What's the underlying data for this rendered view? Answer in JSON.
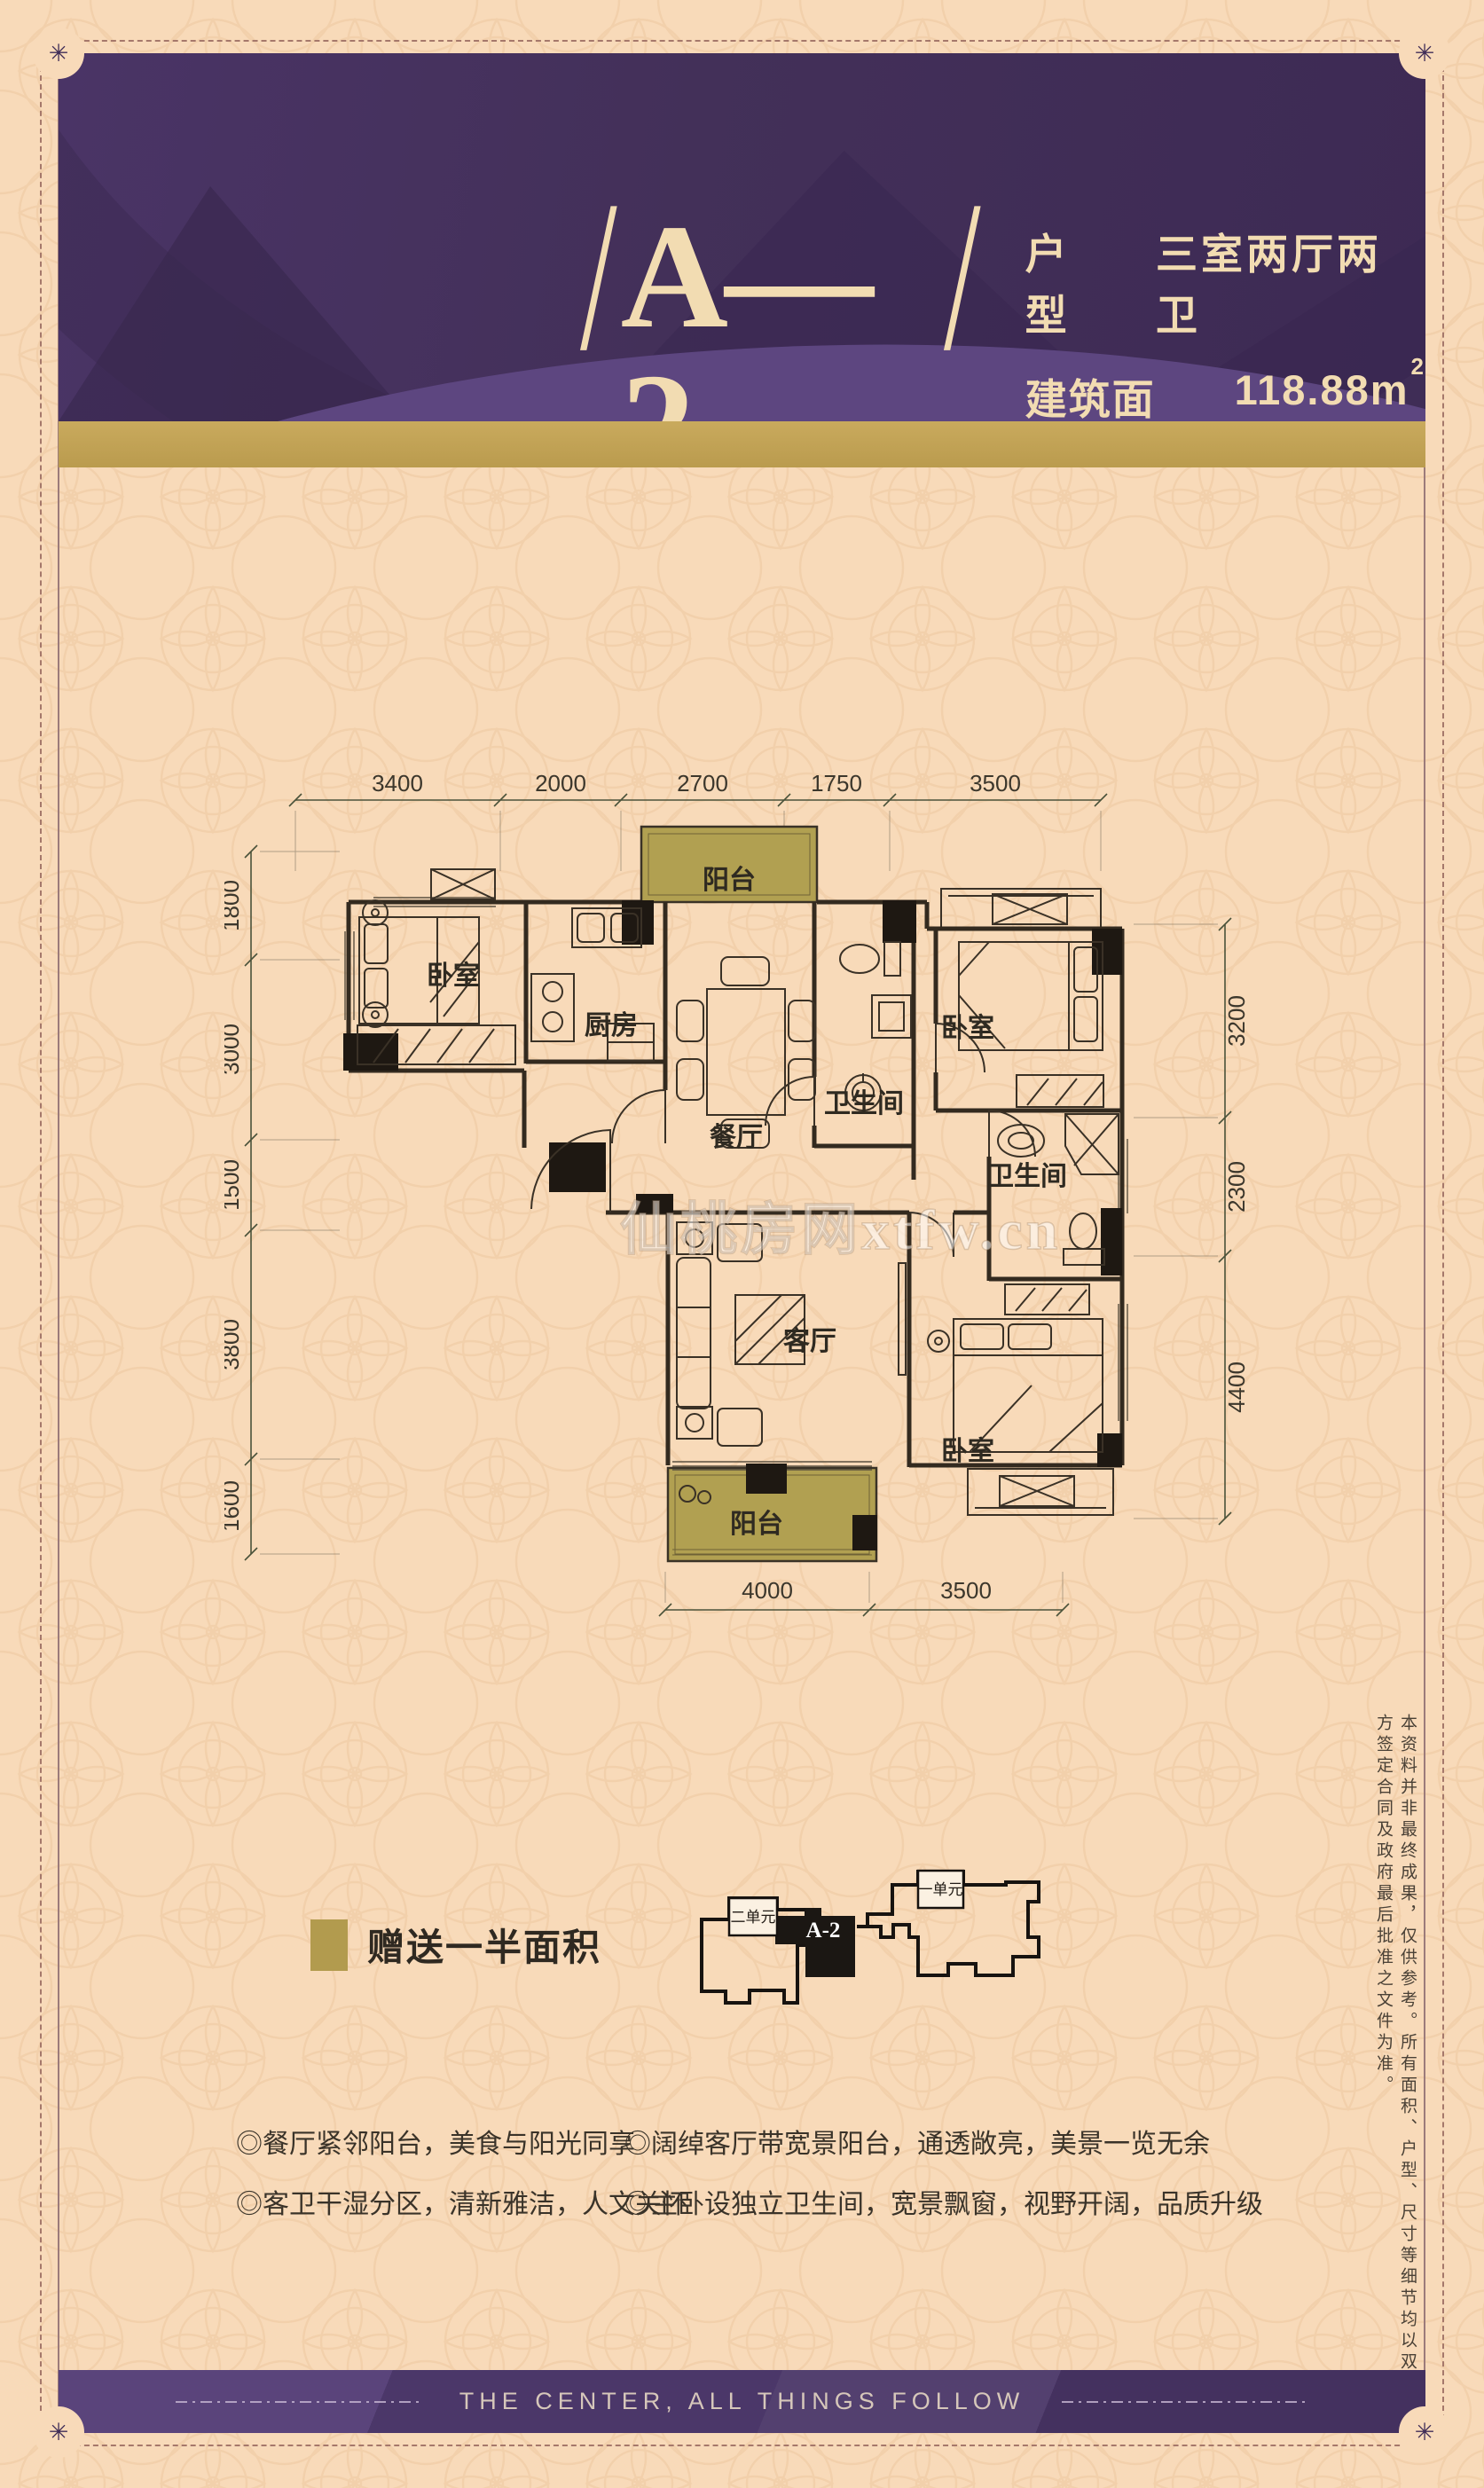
{
  "header": {
    "slash_left": "/",
    "unit_code": "A—2",
    "slash_right": "/",
    "type_label": "户型",
    "type_value": "三室两厅两卫",
    "area_label": "建筑面积：",
    "area_value": "118.88m",
    "area_sup": "2"
  },
  "plan": {
    "watermark": "仙桃房网xtfw.cn",
    "dims_top": [
      "3400",
      "2000",
      "2700",
      "1750",
      "3500"
    ],
    "dims_left": [
      "1800",
      "3000",
      "1500",
      "3800",
      "1600"
    ],
    "dims_right": [
      "3200",
      "2300",
      "4400"
    ],
    "dims_bottom": [
      "4000",
      "3500"
    ],
    "rooms": {
      "bedroom_left": "卧室",
      "kitchen": "厨房",
      "balcony_top": "阳台",
      "dining": "餐厅",
      "bath_top": "卫生间",
      "bedroom_right": "卧室",
      "bath_mid": "卫生间",
      "living": "客厅",
      "bedroom_bottom": "卧室",
      "balcony_bottom": "阳台"
    }
  },
  "legend": {
    "label": "赠送一半面积",
    "swatch_color": "#b29b4e"
  },
  "keymap": {
    "unit_left": "二单元",
    "unit_right": "一单元",
    "highlight": "A-2"
  },
  "features": [
    "◎餐厅紧邻阳台，美食与阳光同享",
    "◎阔绰客厅带宽景阳台，通透敞亮，美景一览无余",
    "◎客卫干湿分区，清新雅洁，人文关怀",
    "◎主卧设独立卫生间，宽景飘窗，视野开阔，品质升级"
  ],
  "disclaimer": "本资料并非最终成果，仅供参考。所有面积、户型、尺寸等细节均以双方签定合同及政府最后批准之文件为准。",
  "footer": {
    "slogan": "THE CENTER, ALL THINGS FOLLOW"
  },
  "ornament": "✳",
  "colors": {
    "header_purple": "#46315f",
    "gold_bar": "#c1a355",
    "background": "#f8dab9",
    "balcony_fill": "#b1a051",
    "footer_purple": "#4e396b",
    "header_text": "#f2dcb2"
  }
}
